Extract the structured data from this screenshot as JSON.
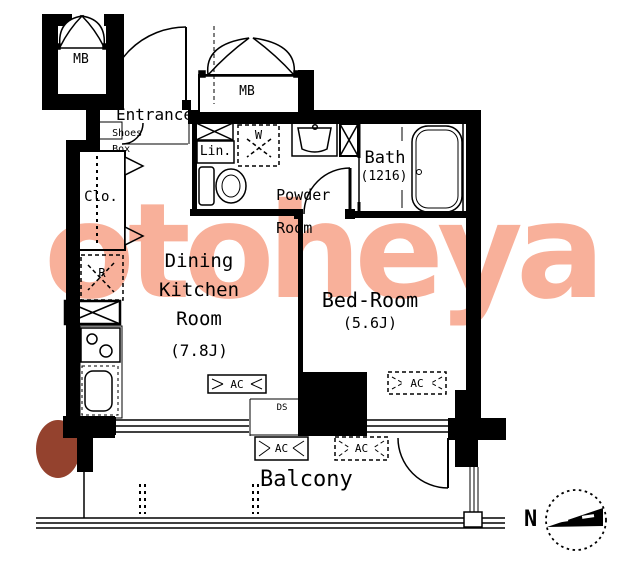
{
  "plan_type": "apartment-floor-plan",
  "colors": {
    "line": "#000000",
    "background": "#ffffff",
    "watermark": "#f8b09a",
    "watermark_blob": "#94422e"
  },
  "watermark": {
    "text": "otoheya"
  },
  "compass": {
    "north_label": "N"
  },
  "rooms": {
    "entrance": {
      "label": "Entrance"
    },
    "shoes_box": {
      "line1": "Shoes",
      "line2": "Box"
    },
    "linen": {
      "label": "Lin."
    },
    "washer": {
      "label": "W"
    },
    "powder_room": {
      "line1": "Powder",
      "line2": "Room"
    },
    "bath": {
      "label": "Bath",
      "size": "(1216)"
    },
    "closet": {
      "label": "Clo."
    },
    "refrigerator": {
      "label": "R"
    },
    "dining_kitchen": {
      "line1": "Dining",
      "line2": "Kitchen",
      "line3": "Room",
      "size": "(7.8J)"
    },
    "bedroom": {
      "label": "Bed-Room",
      "size": "(5.6J)"
    },
    "balcony": {
      "label": "Balcony"
    },
    "meter_box_left": {
      "label": "MB"
    },
    "meter_box_top": {
      "label": "MB"
    },
    "duct_space": {
      "label": "DS"
    }
  },
  "equipment": {
    "ac_dining": "AC",
    "ac_bedroom": "AC",
    "ac_balcony_left": "AC",
    "ac_balcony_right": "AC"
  }
}
